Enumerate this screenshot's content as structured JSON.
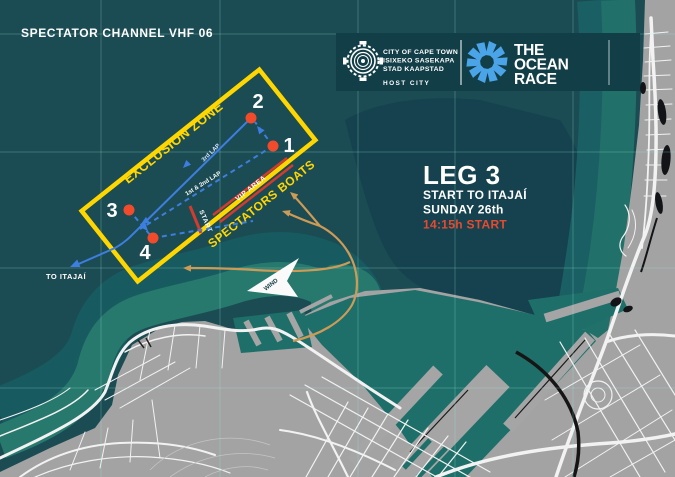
{
  "header": {
    "spectator_channel": "SPECTATOR CHANNEL VHF 06",
    "host_city": {
      "line1": "CITY OF CAPE TOWN",
      "line2": "ISIXEKO SASEKAPA",
      "line3": "STAD KAAPSTAD",
      "label": "HOST CITY"
    },
    "ocean_race": {
      "line1": "THE",
      "line2": "OCEAN",
      "line3": "RACE"
    }
  },
  "leg_info": {
    "title": "LEG 3",
    "subtitle": "START TO ITAJAÍ",
    "date": "SUNDAY 26th",
    "start_time": "14:15h START"
  },
  "course": {
    "exclusion_zone_label": "EXCLUSION ZONE",
    "spectators_boats_label": "SPECTATORS BOATS",
    "vip_area_label": "VIP AREA",
    "start_label": "START",
    "lap3_label": "3rd LAP",
    "lap12_label": "1st & 2nd LAP",
    "to_itajai_label": "TO ITAJAÍ",
    "wind_label": "WIND",
    "marks": [
      {
        "id": "1"
      },
      {
        "id": "2"
      },
      {
        "id": "3"
      },
      {
        "id": "4"
      }
    ]
  },
  "colors": {
    "water_deep": "#15424E",
    "water_base": "#1B4B53",
    "water_shallow": "#27796D",
    "land": "#A3A3A3",
    "exclusion_yellow": "#FFD600",
    "mark_red": "#F14B2C",
    "start_line_red": "#D23B2E",
    "route_blue": "#3D7EE0",
    "spectator_tan": "#CE9B57",
    "start_time_red": "#E84A2F",
    "ocean_race_blue": "#4BA4E8",
    "header_band": "#123E48"
  }
}
